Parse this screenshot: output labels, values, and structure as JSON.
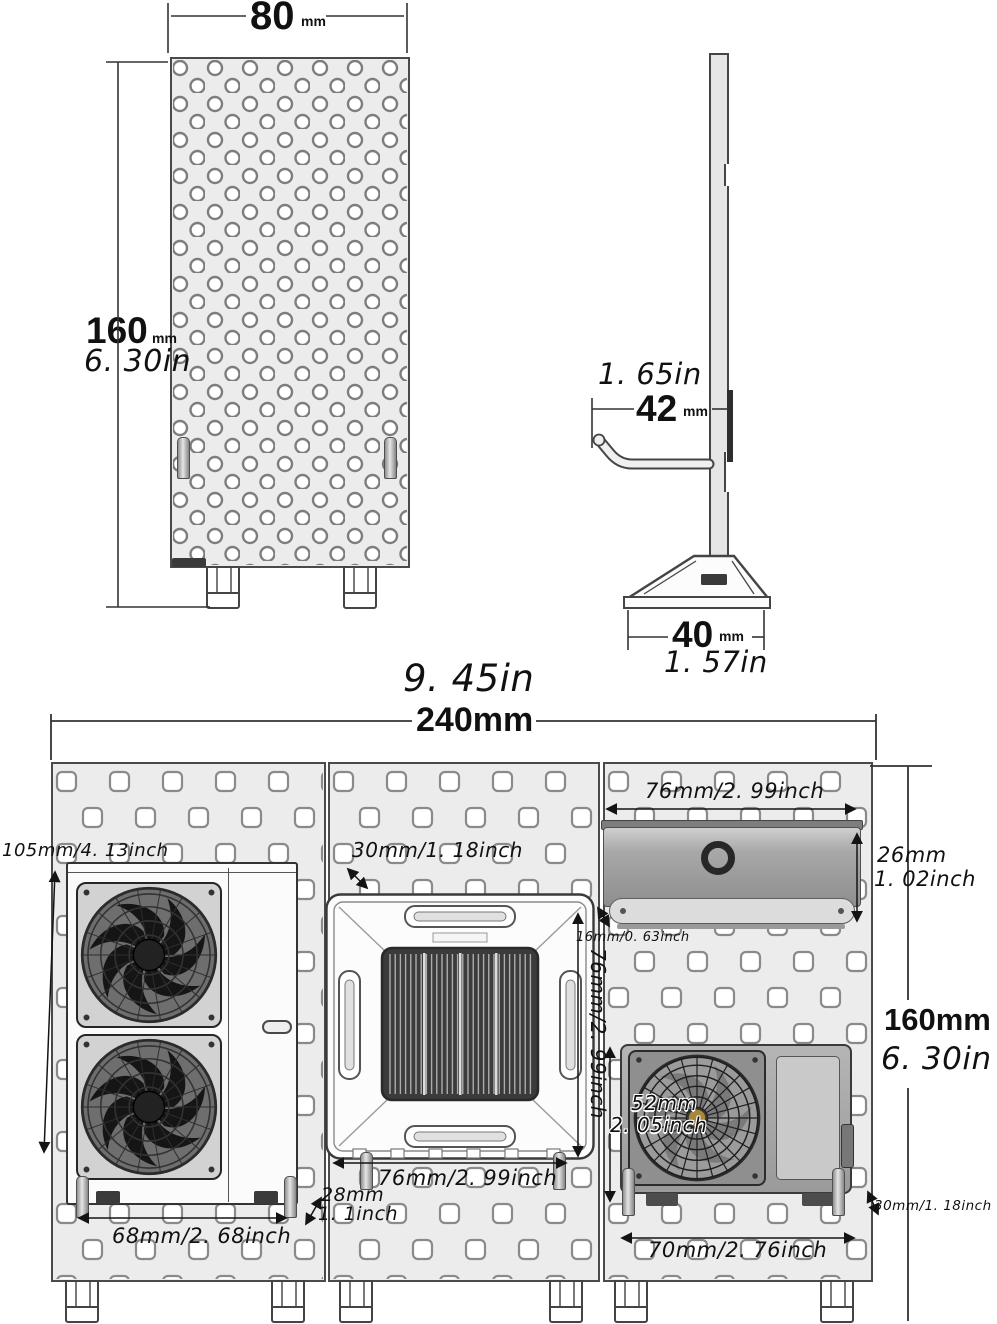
{
  "meta": {
    "background": "#ffffff",
    "board_fill": "#ececec",
    "hole_stroke": "#7d7d7d",
    "line_color": "#161616",
    "unit_gray": "#a0a0a0",
    "hub_gold": "#a8873c"
  },
  "front_view": {
    "width_mm": "80",
    "width_unit": "mm",
    "height_mm": "160",
    "height_unit": "mm",
    "height_in": "6. 30in"
  },
  "side_view": {
    "hook_in": "1. 65in",
    "hook_mm": "42",
    "hook_unit": "mm",
    "base_mm": "40",
    "base_unit": "mm",
    "base_in": "1. 57in"
  },
  "assembly": {
    "total_in": "9. 45in",
    "total_mm": "240mm",
    "board_height_mm": "160mm",
    "board_height_in": "6. 30in",
    "outdoor_large": {
      "height": "105mm/4. 13inch",
      "width": "68mm/2. 68inch",
      "peg_mm": "28mm",
      "peg_in": "1. 1inch"
    },
    "cassette": {
      "depth": "30mm/1. 18inch",
      "width_bottom": "76mm/2. 99inch",
      "height_side": "76mm/2. 99inch"
    },
    "wall_unit": {
      "width": "76mm/2. 99inch",
      "height_mm": "26mm",
      "height_in": "1. 02inch",
      "depth": "16mm/0. 63inch"
    },
    "outdoor_small": {
      "height_mm": "52mm",
      "height_in": "2. 05inch",
      "width": "70mm/2. 76inch",
      "depth": "30mm/1. 18inch"
    }
  }
}
